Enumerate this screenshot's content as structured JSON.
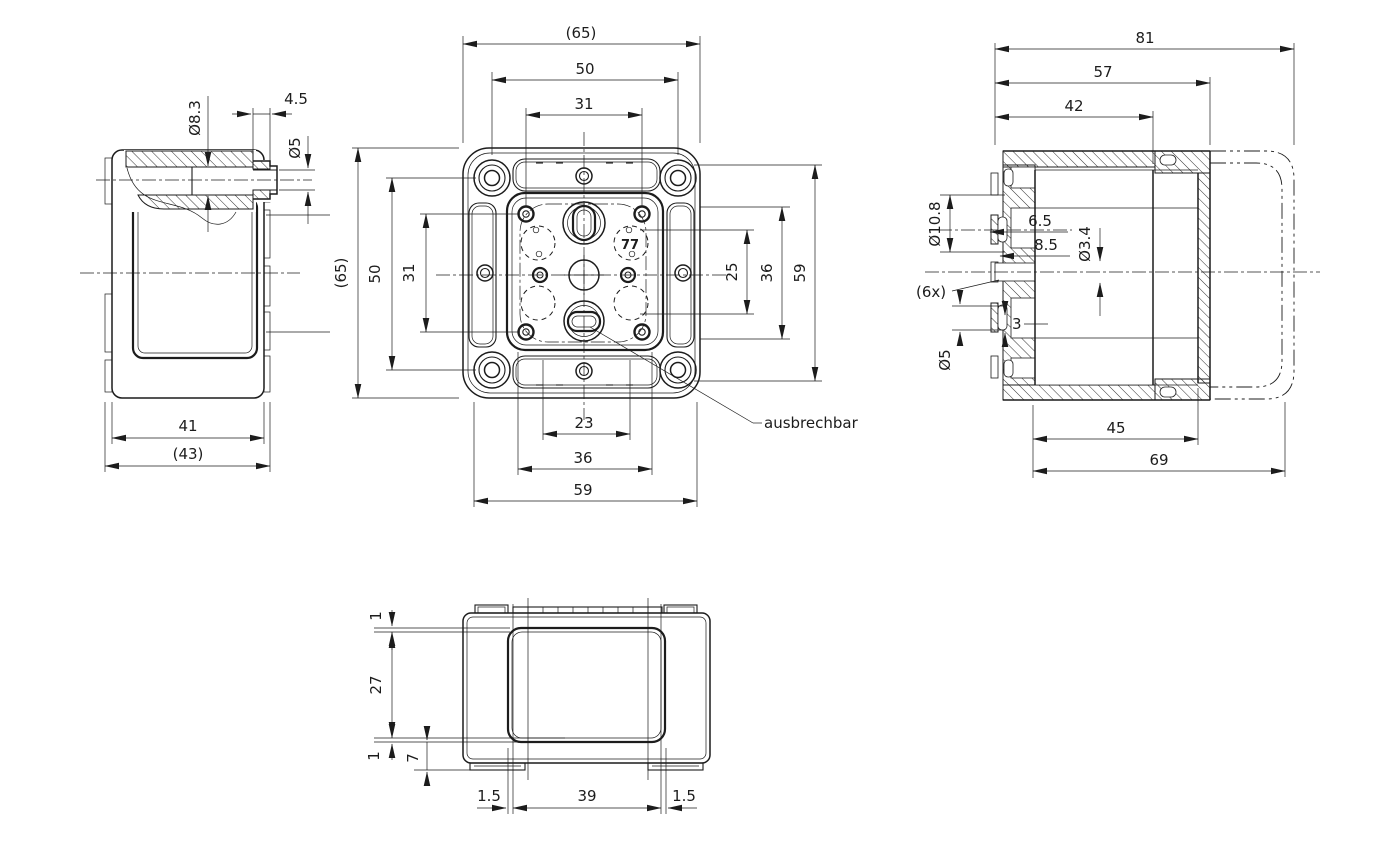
{
  "drawing": {
    "bg": "#ffffff",
    "ink": "#1c1c1c",
    "views": {
      "side": {
        "dia_bore": "Ø8.3",
        "stub_len": "4.5",
        "dia_stub": "Ø5",
        "width_inner": "41",
        "width_outer": "(43)"
      },
      "front": {
        "top": {
          "overall": "(65)",
          "screws": "50",
          "bosses": "31"
        },
        "left": {
          "overall": "(65)",
          "screws": "50",
          "bosses": "31"
        },
        "right": {
          "glands": "25",
          "mid": "36",
          "inner": "59"
        },
        "bottom": {
          "slot": "23",
          "mid": "36",
          "inner": "59"
        },
        "marking": "77",
        "callout": "ausbrechbar"
      },
      "section": {
        "top": {
          "overall": "81",
          "body": "57",
          "inner": "42"
        },
        "left": {
          "dia_terminal": "Ø10.8",
          "off1": "6.5",
          "off2": "8.5",
          "dia_hole": "Ø3.4",
          "count": "(6x)",
          "slot": "3",
          "dia_lower": "Ø5"
        },
        "bottom": {
          "inner": "45",
          "flange": "69"
        }
      },
      "bottomview": {
        "left": {
          "lip_top": "1",
          "depth": "27",
          "lip_bottom": "1",
          "foot": "7"
        },
        "bottom": {
          "left_off": "1.5",
          "width": "39",
          "right_off": "1.5"
        }
      }
    }
  }
}
